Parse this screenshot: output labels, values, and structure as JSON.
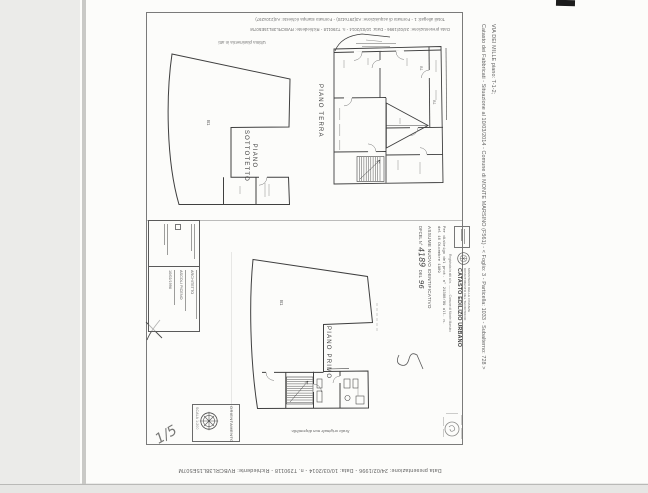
{
  "colors": {
    "ink": "#3f3f3f",
    "faint_ink": "#6e6e6e",
    "paper": "#fcfcfa",
    "backdrop": "#ebebe9"
  },
  "header": {
    "totali": "Totali allegati: 1 - Formato di acquisizione: A3(297x420) - Formato stampa richiesto: A4(210x297)",
    "presentazione": "Data presentazione: 24/02/1996 - Data: 10/03/2014 - n. T290118 - Richiedente: RVBCRL38L15E507M",
    "ultima": "Ultima planimetria in atti"
  },
  "footer": {
    "presentazione": "Data presentazione: 24/02/1996 - Data: 10/03/2014 - n. T290118 - Richiedente: RVBCRL38L15E507M"
  },
  "side_caption": {
    "catasto": "Catasto dei Fabbricati - Situazione al 10/03/2014 - Comune di MONTE MARSINO (F561) - < Foglio: 3 - Particella: 1033 - Subalterno: 728 >",
    "via": "VIA DEI MILLE piano: T-1-2;"
  },
  "plans": {
    "sottotetto_line1": "PIANO",
    "sottotetto_line2": "SOTTOTETTO",
    "terra": "PIANO TERRA",
    "primo": "PIANO PRIMO",
    "room_code": "B1"
  },
  "declarant_stamp": {
    "role": "ARCHITETTO",
    "province": "ASCOLI PICENO",
    "date": "10/02/1996"
  },
  "catasto_stamp": {
    "ministry_line1": "MINISTERO DELLE FINANZE",
    "ministry_line2": "DIPARTIMENTO DEL TERRITORIO",
    "title": "CATASTO EDILIZIO URBANO",
    "registered": "Registrata in atti al n. .......... Comune di Monte Marsino",
    "protocol_line1": "Per disbrigo del prot. n° 21380/89 all. n.",
    "protocol_line2": "del 16 Dicembre 1989",
    "assume_title": "ASSUME NUOVO IDENTIFICATIVO",
    "assume_prefix": "DFCEL N°",
    "assume_number": "4189",
    "assume_del": "DEL",
    "assume_year": "96"
  },
  "orientation": {
    "label": "ORIENTAMENTO",
    "scale": "SCALA 1:200"
  },
  "notes": {
    "scale_note": "Scala originale non disponibile.",
    "sheet_number": "1/5"
  }
}
